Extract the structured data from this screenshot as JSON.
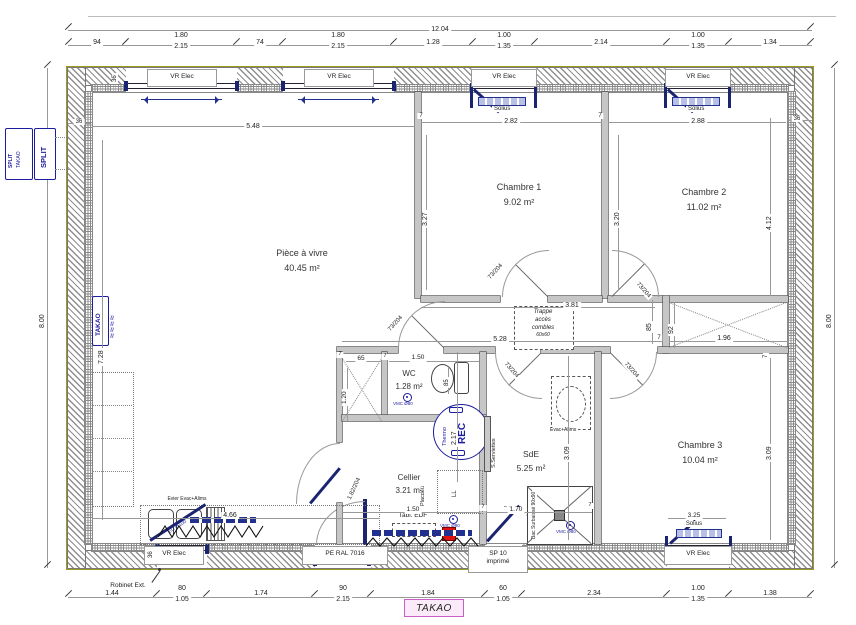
{
  "title": "TAKAO",
  "rooms": {
    "piece": {
      "name": "Pièce à vivre",
      "area": "40.45 m²"
    },
    "chambre1": {
      "name": "Chambre 1",
      "area": "9.02 m²"
    },
    "chambre2": {
      "name": "Chambre 2",
      "area": "11.02 m²"
    },
    "chambre3": {
      "name": "Chambre 3",
      "area": "10.04 m²"
    },
    "wc": {
      "name": "WC",
      "area": "1.28 m²"
    },
    "cellier": {
      "name": "Cellier",
      "area": "3.21 m²"
    },
    "sde": {
      "name": "SdE",
      "area": "5.25 m²"
    }
  },
  "dims": {
    "total_w": "12.04",
    "h_left": "8.00",
    "h_right": "8.00",
    "top": [
      "94",
      "1.80",
      "74",
      "1.80",
      "1.28",
      "1.00",
      "2.14",
      "1.00",
      "1.34"
    ],
    "top_sub": [
      "2.15",
      "2.15",
      "1.35",
      "1.35"
    ],
    "bottom": [
      "1.44",
      "80",
      "1.74",
      "90",
      "1.84",
      "60",
      "2.34",
      "1.00",
      "1.38"
    ],
    "bottom_sub": [
      "1.05",
      "2.15",
      "1.05",
      "1.35"
    ],
    "living_w": "5.48",
    "living_h": "7.28",
    "ch1_w": "2.82",
    "ch2_w": "2.88",
    "ch1_h": "3.27",
    "mid_h": "3.20",
    "right_h": "4.12",
    "hall_a": "3.81",
    "hall_b": "5.28",
    "pl_right_w": "1.96",
    "d85": "85",
    "d92": "92",
    "wc_w": "1.50",
    "wc_d": "85",
    "pl_w": "65",
    "pl_h": "1.20",
    "cel_h": "2.17",
    "cel_w": "1.50",
    "sde_h": "3.09",
    "shower_w": "1.70",
    "ch3_h": "3.09",
    "ch3_win": "3.25",
    "kitchen_w": "4.66",
    "w36": "36",
    "w7": "7"
  },
  "windows": {
    "vr": "VR Elec",
    "solius": "Solius"
  },
  "doors": {
    "int": "73/204",
    "cellier": "1.82/204",
    "pe": "PE RAL 7016",
    "sp1": "SP 10",
    "sp2": "imprimé"
  },
  "equip": {
    "split1a": "SPLIT",
    "split1b": "TAKAO",
    "split2": "SPLIT",
    "takao_rad": "TAKAO",
    "vmc": "VMC Ø80",
    "rec": "REC",
    "thermo": "Thermo",
    "towel": "S.Serviettes",
    "evac": "Evac+Alims",
    "shower": "Bac Surbaissé 90x90",
    "trappe1": "Trappe",
    "trappe2": "accès",
    "trappe3": "combles",
    "trappe4": "60x60",
    "edf": "Tabl. EDF",
    "placdeu": "Placdeu",
    "ll": "LL",
    "sink": "Evier Evac+Alims",
    "eu": "EU Ø100",
    "dec": "DEC EU",
    "robinet": "Robinet Ext."
  },
  "colors": {
    "accent_blue": "#1c1c9e",
    "wall_olive": "#9a9b1f",
    "magenta": "#c75fc7",
    "red": "#d91111"
  }
}
